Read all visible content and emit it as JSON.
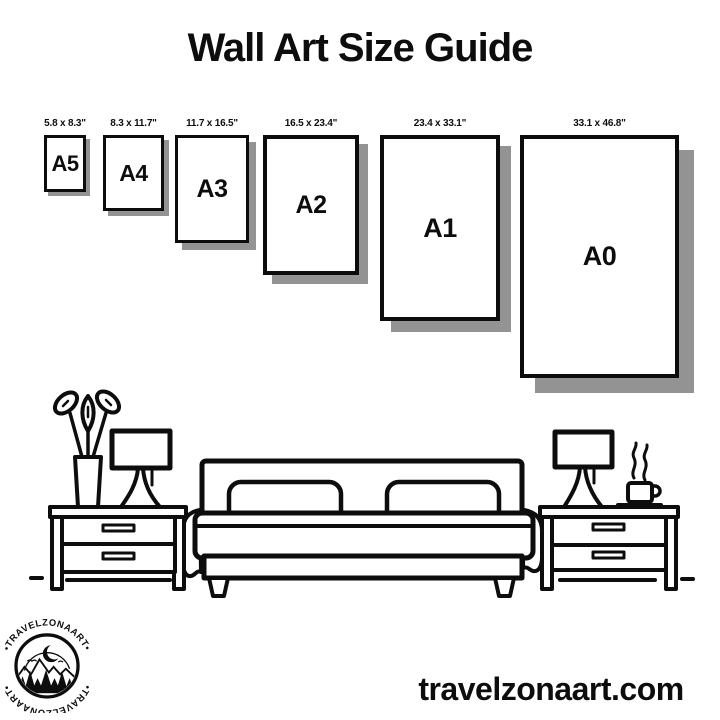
{
  "title": "Wall Art Size Guide",
  "sizes": [
    {
      "code": "A5",
      "dims": "5.8 x 8.3\""
    },
    {
      "code": "A4",
      "dims": "8.3 x 11.7\""
    },
    {
      "code": "A3",
      "dims": "11.7 x 16.5\""
    },
    {
      "code": "A2",
      "dims": "16.5 x 23.4\""
    },
    {
      "code": "A1",
      "dims": "23.4 x 33.1\""
    },
    {
      "code": "A0",
      "dims": "33.1 x 46.8\""
    }
  ],
  "logo": {
    "arc_text": "•TRAVELZONAART•"
  },
  "website": "travelzonaart.com",
  "colors": {
    "ink": "#0d0d0d",
    "background": "#ffffff",
    "frame_shadow": "#939393"
  }
}
